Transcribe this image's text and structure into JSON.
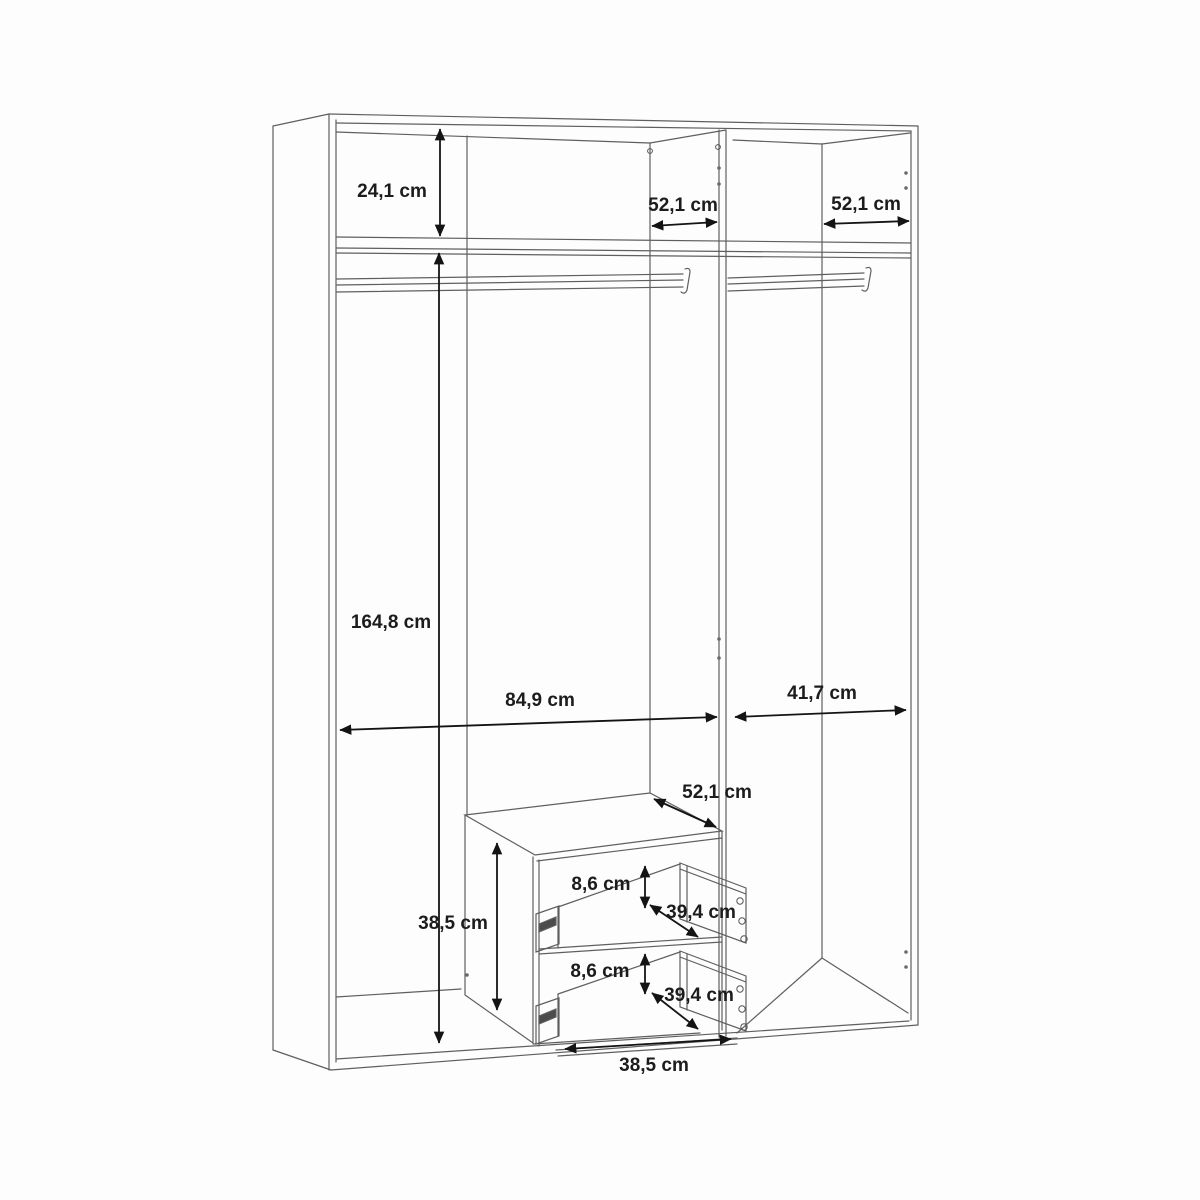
{
  "diagram": {
    "subject": "wardrobe interior dimension drawing",
    "unit": "cm",
    "background_color": "#fdfdfd",
    "line_color": "#5f5f5f",
    "dimension_line_color": "#141414",
    "text_color": "#1c1c1c",
    "dimensions": [
      {
        "id": "top-shelf-height",
        "label": "24,1 cm"
      },
      {
        "id": "upper-depth-left",
        "label": "52,1 cm"
      },
      {
        "id": "upper-depth-right",
        "label": "52,1 cm"
      },
      {
        "id": "hanging-space-height",
        "label": "164,8 cm"
      },
      {
        "id": "left-section-width",
        "label": "84,9 cm"
      },
      {
        "id": "right-section-width",
        "label": "41,7 cm"
      },
      {
        "id": "drawer-unit-depth",
        "label": "52,1 cm"
      },
      {
        "id": "drawer-unit-height",
        "label": "38,5 cm"
      },
      {
        "id": "drawer-opening-height-top",
        "label": "8,6 cm"
      },
      {
        "id": "drawer-depth-top",
        "label": "39,4 cm"
      },
      {
        "id": "drawer-opening-height-bot",
        "label": "8,6 cm"
      },
      {
        "id": "drawer-depth-bot",
        "label": "39,4 cm"
      },
      {
        "id": "drawer-unit-width",
        "label": "38,5 cm"
      }
    ]
  }
}
